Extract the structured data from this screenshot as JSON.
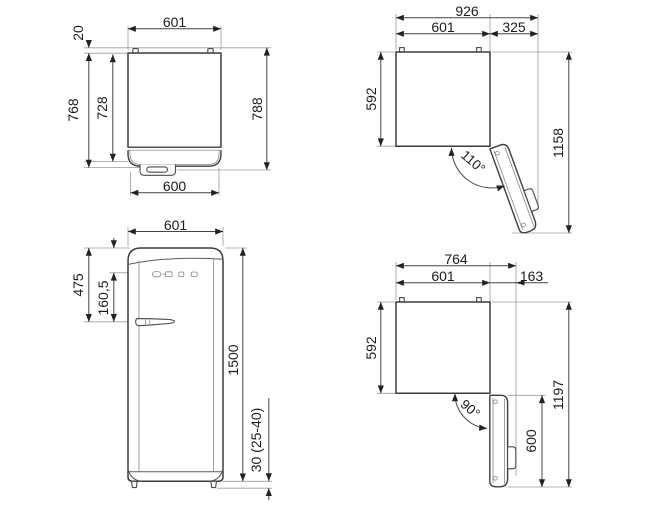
{
  "drawing": {
    "views": {
      "topClosed": {
        "dims": {
          "width": "601",
          "hingeGap": "20",
          "depthBody": "768",
          "depthInner": "728",
          "depthTotal": "788",
          "widthFront": "600"
        }
      },
      "topOpen110": {
        "dims": {
          "widthTotal": "926",
          "widthBody": "601",
          "doorSwing": "325",
          "depthBody": "592",
          "depthTotal": "1158",
          "angle": "110°"
        }
      },
      "front": {
        "dims": {
          "width": "601",
          "topToHandle": "475",
          "panelToHandle": "160,5",
          "height": "1500",
          "feet": "30 (25-40)"
        }
      },
      "topOpen90": {
        "dims": {
          "widthTotal": "764",
          "widthBody": "601",
          "doorSwing": "163",
          "depthBody": "592",
          "depthTotal": "1197",
          "doorWidth": "600",
          "angle": "90°"
        }
      }
    }
  }
}
